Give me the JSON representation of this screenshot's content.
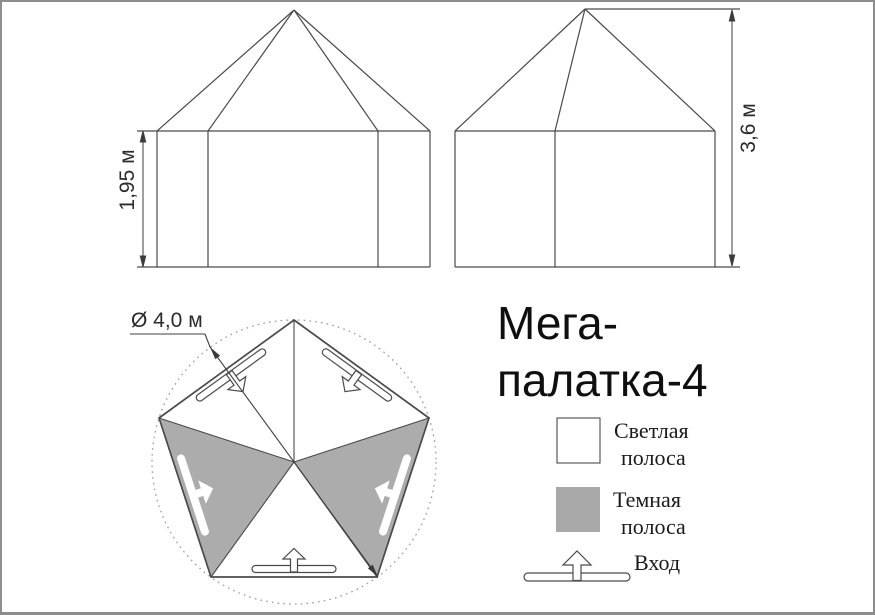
{
  "title": {
    "line1": "Мега-",
    "line2": "палатка-4"
  },
  "dimensions": {
    "front_height": "1,95 м",
    "side_height": "3,6 м",
    "plan_diameter": "Ø 4,0 м"
  },
  "legend": {
    "light_stripe": {
      "line1": "Светлая",
      "line2": "полоса",
      "swatch_color": "#ffffff"
    },
    "dark_stripe": {
      "line1": "Темная",
      "line2": "полоса",
      "swatch_color": "#a9a9a9"
    },
    "entrance": {
      "label": "Вход"
    }
  },
  "colors": {
    "line": "#4a4a4a",
    "dark_panel": "#acacac",
    "dotted_circle": "#9a9a9a"
  }
}
